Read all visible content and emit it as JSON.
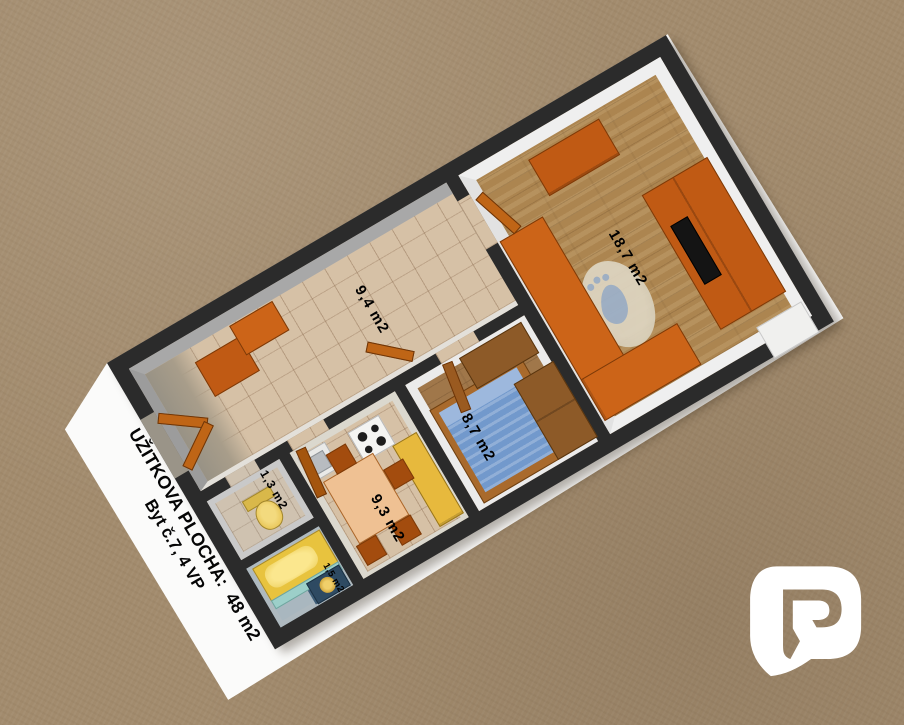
{
  "floorplan": {
    "title_line1": "UŽITKOVA PLOCHA:  48 m2",
    "title_line2": "Byt č.7, 4 VP",
    "total_area": "48 m2",
    "unit": "Byt č.7, 4 VP",
    "rooms": [
      {
        "id": "living-room",
        "area_label": "18,7 m2"
      },
      {
        "id": "hallway",
        "area_label": "9,4 m2"
      },
      {
        "id": "bedroom",
        "area_label": "8,7 m2"
      },
      {
        "id": "kitchen",
        "area_label": "9,3 m2"
      },
      {
        "id": "wc",
        "area_label": "1,3 m2"
      },
      {
        "id": "bathroom",
        "area_label": "1,5 m2"
      }
    ],
    "colors": {
      "background": "#a28b6d",
      "paper": "#fbfbfa",
      "walls": "#2b2b2b",
      "tile_floor": "#d6c1a6",
      "wood_floor": "#ac8550",
      "furniture_orange": "#cc6418",
      "wardrobe_brown": "#8d5a28",
      "bed_blue": "#7299cc",
      "bathtub_yellow": "#eec94a",
      "washer_slate": "#2e4a62"
    }
  },
  "logo": {
    "glyph": "R",
    "color": "#ffffff"
  }
}
